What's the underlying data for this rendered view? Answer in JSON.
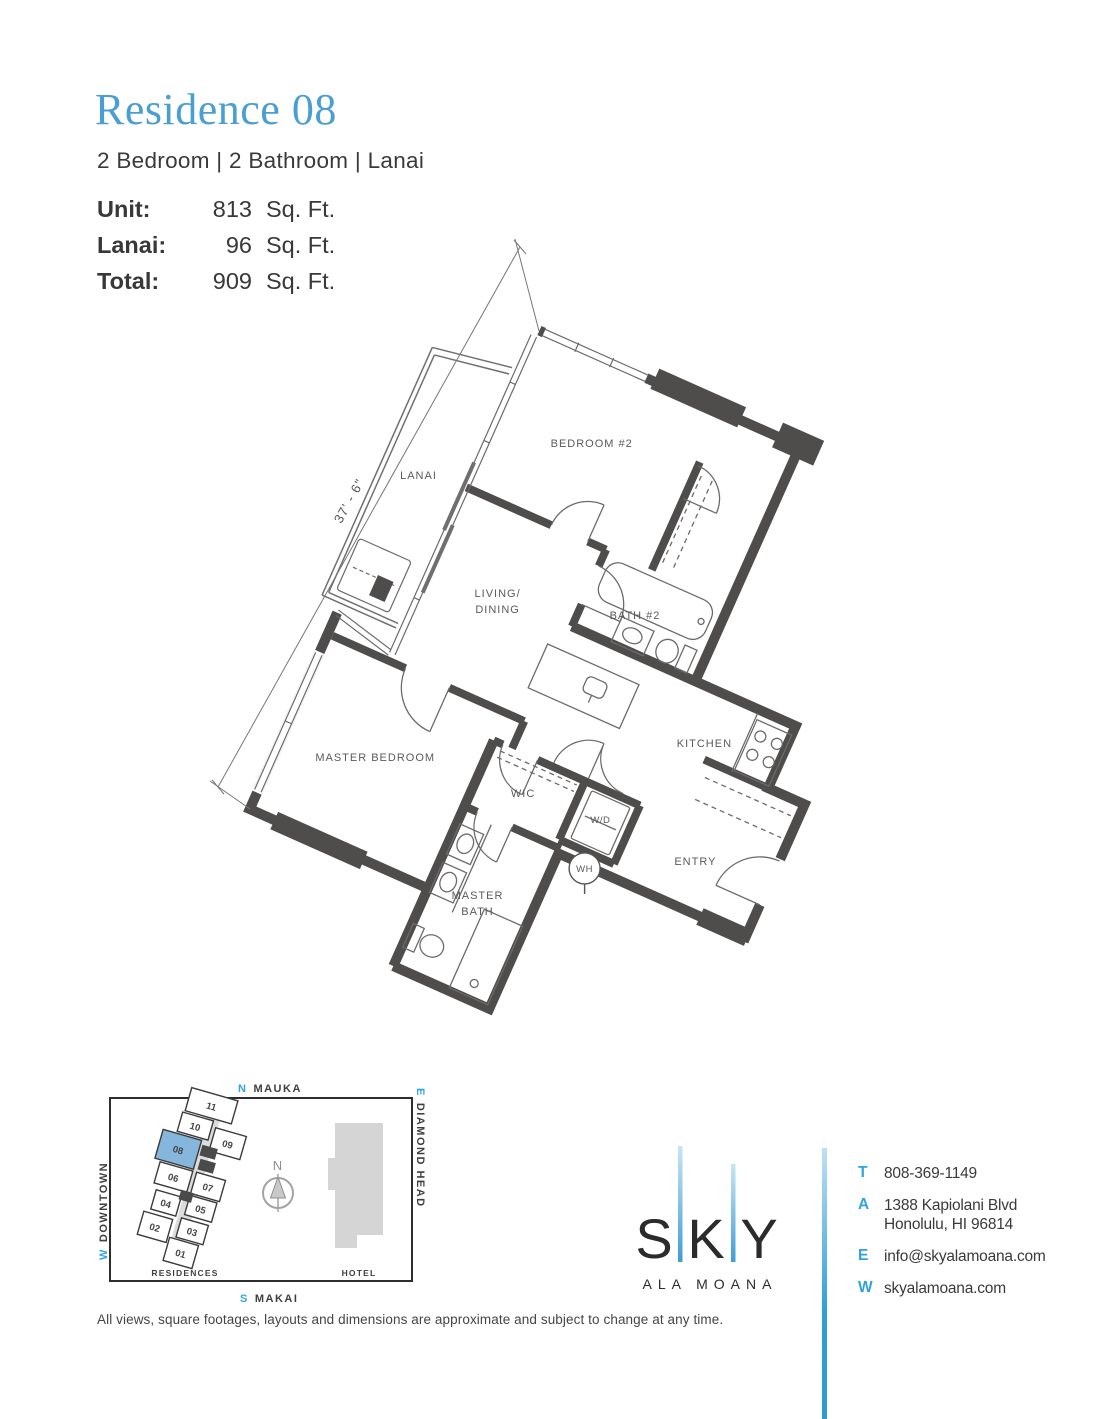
{
  "page": {
    "title": "Residence 08",
    "subtitle": "2 Bedroom | 2 Bathroom | Lanai"
  },
  "stats": [
    {
      "label": "Unit:",
      "value": "813",
      "unit": "Sq. Ft."
    },
    {
      "label": "Lanai:",
      "value": "96",
      "unit": "Sq. Ft."
    },
    {
      "label": "Total:",
      "value": "909",
      "unit": "Sq. Ft."
    }
  ],
  "floorplan": {
    "dimension": "37' - 6\"",
    "rooms": {
      "lanai": "LANAI",
      "bedroom2": "BEDROOM #2",
      "bath2": "BATH #2",
      "living1": "LIVING/",
      "living2": "DINING",
      "kitchen": "KITCHEN",
      "master": "MASTER BEDROOM",
      "wic": "WIC",
      "wd": "W/D",
      "wh": "WH",
      "entry": "ENTRY",
      "mbath1": "MASTER",
      "mbath2": "BATH"
    }
  },
  "keyplan": {
    "directions": {
      "north": {
        "letter": "N",
        "word": "MAUKA"
      },
      "south": {
        "letter": "S",
        "word": "MAKAI"
      },
      "west": {
        "letter": "W",
        "word": "DOWNTOWN"
      },
      "east": {
        "letter": "E",
        "word": "DIAMOND HEAD"
      }
    },
    "compass": "N",
    "units": [
      "11",
      "10",
      "09",
      "08",
      "07",
      "06",
      "05",
      "04",
      "03",
      "02",
      "01"
    ],
    "highlighted_unit": "08",
    "residences_label": "RESIDENCES",
    "hotel_label": "HOTEL"
  },
  "brand": {
    "letters": [
      "S",
      "K",
      "Y"
    ],
    "sub": "ALA MOANA"
  },
  "contact": {
    "rows": [
      {
        "label": "T",
        "line1": "808-369-1149"
      },
      {
        "label": "A",
        "line1": "1388 Kapiolani Blvd",
        "line2": "Honolulu, HI 96814"
      },
      {
        "label": "E",
        "line1": "info@skyalamoana.com"
      },
      {
        "label": "W",
        "line1": "skyalamoana.com"
      }
    ]
  },
  "disclaimer": {
    "text": "All views, square footages, layouts and dimensions are approximate and subject to change at any time."
  },
  "colors": {
    "title_blue": "#4a9fd2",
    "accent_blue": "#2fa3dd",
    "wall_gray": "#4f4c4c",
    "keyplan_unit_blue": "#85b7dc",
    "hotel_gray": "#d5d5d5"
  }
}
